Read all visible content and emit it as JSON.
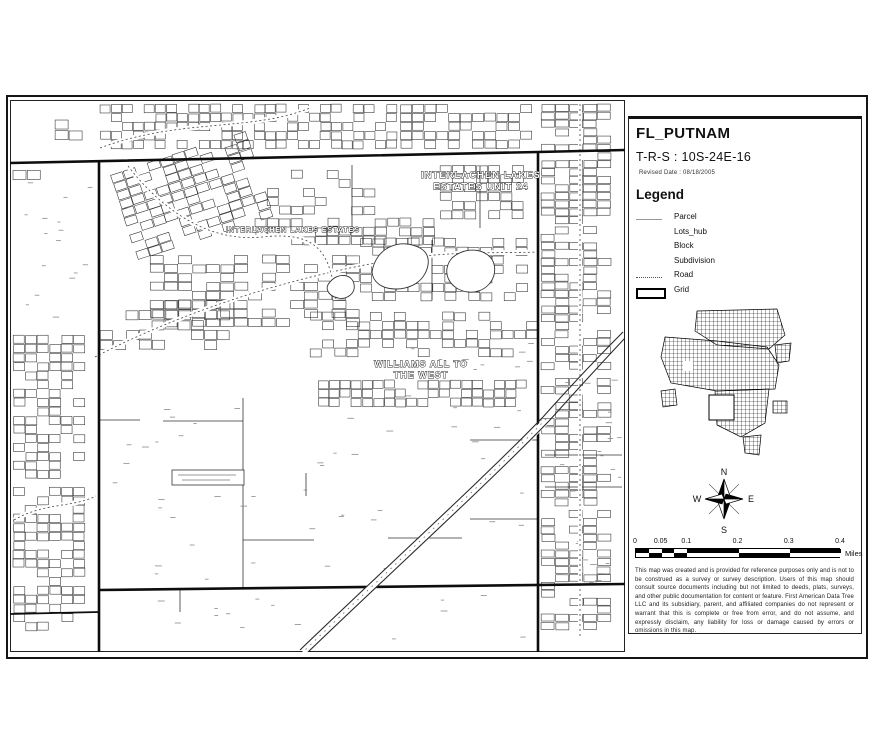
{
  "title_block": {
    "title": "FL_PUTNAM",
    "trs": "T-R-S : 10S-24E-16",
    "revised_date": "Revised Date : 08/18/2005"
  },
  "legend": {
    "title": "Legend",
    "items": [
      {
        "label": "Parcel",
        "symbol": "gray-line"
      },
      {
        "label": "Lots_hub",
        "symbol": "none"
      },
      {
        "label": "Block",
        "symbol": "none"
      },
      {
        "label": "Subdivision",
        "symbol": "none"
      },
      {
        "label": "Road",
        "symbol": "dashed-line"
      },
      {
        "label": "Grid",
        "symbol": "thick-rect"
      }
    ]
  },
  "compass": {
    "north": "N",
    "south": "S",
    "east": "E",
    "west": "W"
  },
  "scale_bar": {
    "tick_labels": [
      "0",
      "0.05",
      "0.1",
      "0.2",
      "0.3",
      "0.4"
    ],
    "tick_fractions": [
      0,
      0.125,
      0.25,
      0.5,
      0.75,
      1
    ],
    "unit": "Miles"
  },
  "disclaimer": "This map was created and is provided for reference purposes only and is not to be construed as a survey or survey description. Users of this map should consult source documents including but not limited to deeds, plats, surveys, and other public documentation for content or feature. First American Data Tree LLC and its subsidiary, parent, and affiliated companies do not represent or warrant that this is complete or free from error, and do not assume, and expressly disclaim, any liability for loss or damage caused by errors or omissions in this map.",
  "map": {
    "labels": [
      {
        "lines": [
          "INTERLACHEN LAKES",
          "ESTATES UNIT 24"
        ],
        "x": 481,
        "y": 178,
        "size": 9.5
      },
      {
        "lines": [
          "INTERLACHEN LAKES ESTATES"
        ],
        "x": 293,
        "y": 232,
        "size": 7
      },
      {
        "lines": [
          "WILLIAMS ALL TO",
          "THE WEST"
        ],
        "x": 421,
        "y": 367,
        "size": 9
      }
    ]
  },
  "colors": {
    "ink": "#1a1a1a",
    "parcel_symbol": "#999999",
    "paper": "#ffffff"
  }
}
